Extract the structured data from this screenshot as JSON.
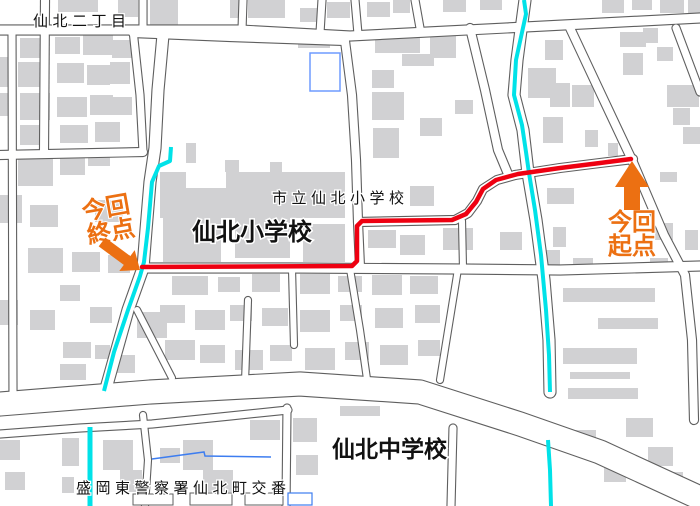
{
  "map": {
    "labels": {
      "district": "仙北二丁目",
      "elementary_school_official": "市立仙北小学校",
      "elementary_school": "仙北小学校",
      "junior_high_school": "仙北中学校",
      "police_box": "盛岡東警察署仙北町交番"
    },
    "annotations": {
      "end_point": {
        "line1": "今回",
        "line2": "終点"
      },
      "start_point": {
        "line1": "今回",
        "line2": "起点"
      }
    },
    "colors": {
      "route": "#ee0011",
      "waterway": "#00e2e8",
      "annotation": "#ec7012",
      "building": "#d1d1d3",
      "road_casing": "#5f5f5f",
      "pool_outline": "#6e9bff",
      "stream": "#3d7df0"
    }
  }
}
